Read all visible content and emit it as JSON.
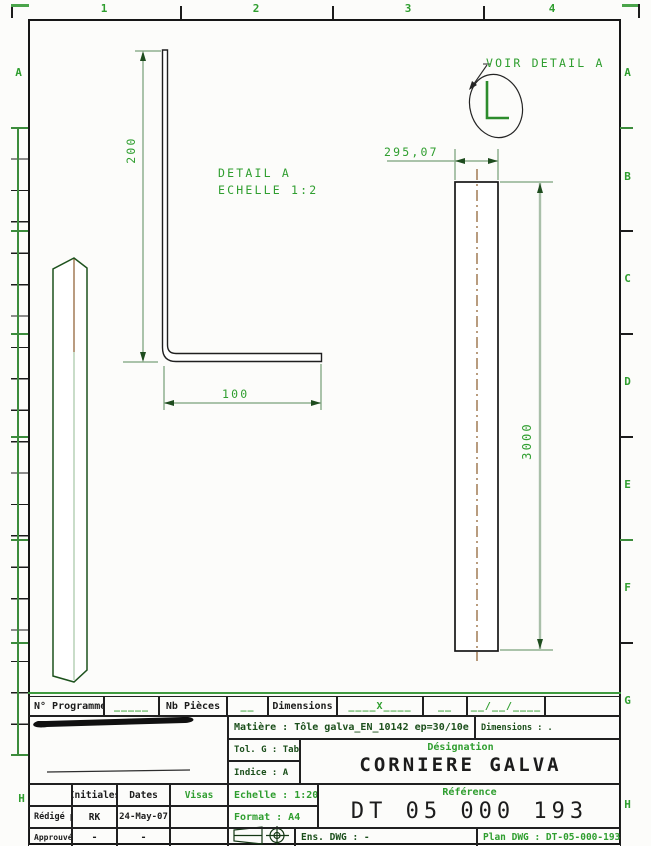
{
  "drawing": {
    "zones": {
      "columns": [
        "1",
        "2",
        "3",
        "4"
      ],
      "rows": [
        "A",
        "B",
        "C",
        "D",
        "E",
        "F",
        "G",
        "H"
      ],
      "left_rows": [
        "A",
        "H"
      ]
    },
    "callout": {
      "label": "VOIR DETAIL A",
      "mark": "L"
    },
    "detail": {
      "title": "DETAIL A",
      "scale": "ECHELLE 1:2",
      "height_dim": "200",
      "width_dim": "100"
    },
    "part": {
      "width_dim": "295,07",
      "length_dim": "3000"
    }
  },
  "title_block": {
    "program": {
      "label": "N° Programme",
      "value": "_____"
    },
    "pieces": {
      "label": "Nb Pièces",
      "value": "__"
    },
    "dimensions": {
      "label": "Dimensions",
      "value": "____X____",
      "extra": "__",
      "date": "__/__/____"
    },
    "matiere": "Matière : Tôle galva_EN_10142 ep=30/10e",
    "dimensions_note": "Dimensions : .",
    "tolerance": "Tol. G : Tableau",
    "indice": "Indice : A",
    "designation": {
      "label": "Désignation",
      "value": "CORNIERE GALVA"
    },
    "echelle": "Echelle : 1:20",
    "format": "Format : A4",
    "reference": {
      "label": "Référence",
      "value": "DT 05 000 193"
    },
    "approval": {
      "headers": [
        "",
        "Initiales",
        "Dates",
        "Visas"
      ],
      "redige": {
        "label": "Rédigé par",
        "initiales": "RK",
        "dates": "24-May-07",
        "visas": ""
      },
      "approuve": {
        "label": "Approuvé par",
        "initiales": "-",
        "dates": "-",
        "visas": ""
      }
    },
    "ens_dwg": "Ens. DWG : -",
    "plan_dwg": "Plan DWG : DT-05-000-193"
  },
  "colors": {
    "cad_green": "#2f9e2f",
    "dark_green": "#1b4f1b",
    "line_black": "#161616",
    "dim_line": "#8fb08f",
    "centerline_brown": "#8a5a2a"
  }
}
